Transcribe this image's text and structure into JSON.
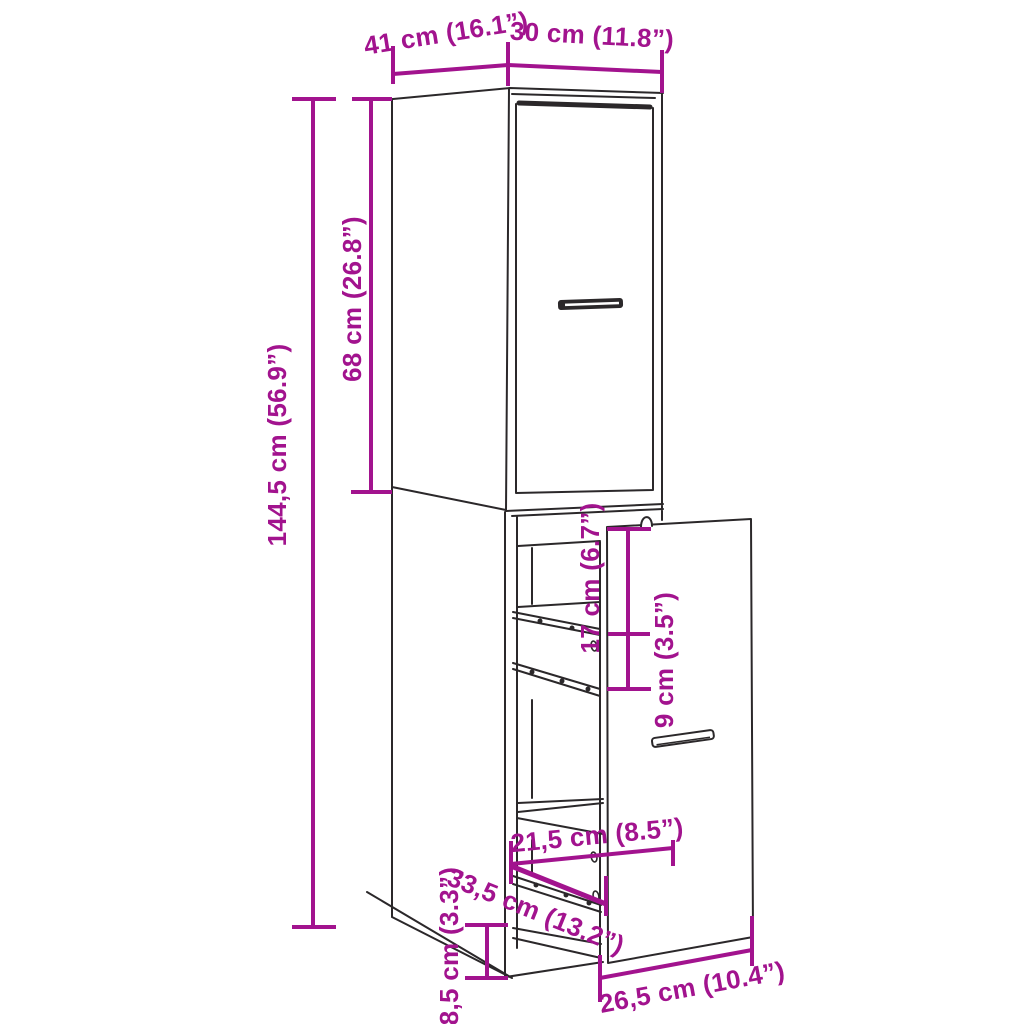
{
  "colors": {
    "dimension": "#A2138E",
    "line_art": "#2B282A",
    "background": "#FFFFFF"
  },
  "labels": {
    "depth": "41 cm (16.1”)",
    "width": "30 cm (11.8”)",
    "total_height": "144,5 cm (56.9”)",
    "upper_height": "68 cm (26.8”)",
    "gap_upper": "17 cm (6.7”)",
    "gap_lower": "9 cm (3.5”)",
    "inner_width": "21,5 cm (8.5”)",
    "diagonal_depth": "33,5 cm (13.2”)",
    "plinth_height": "8,5 cm (3.3”)",
    "panel_width": "26,5 cm (10.4”)"
  }
}
